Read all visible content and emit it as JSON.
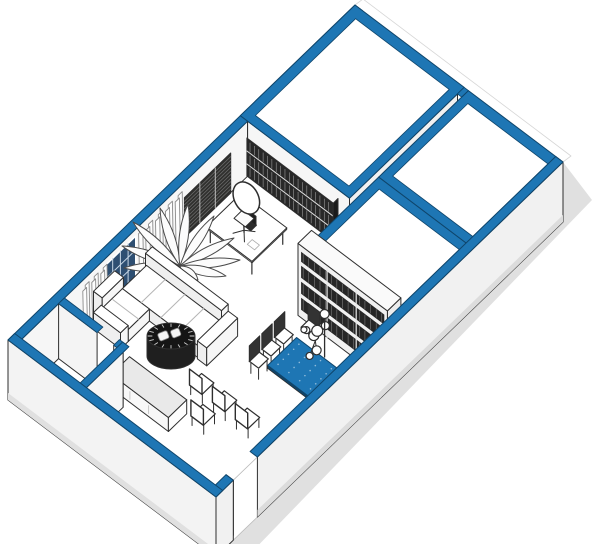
{
  "scene": {
    "label": "Isometric cutaway floor plan of an office suite with blue accent wall tops",
    "background": "#ffffff",
    "canvas": {
      "width": 600,
      "height": 544
    }
  },
  "palette": {
    "accent": "#1E76B4",
    "accent_dark": "#0F456B",
    "ink": "#2E2E2E",
    "glass": "#2E4F72",
    "glass_line": "#C7D6E4",
    "dark_furniture": "#262626",
    "slat_line": "#6E6E6E",
    "wall_face": "#F6F6F6",
    "wall_face_shaded": "#EFEFEF",
    "outer_wall": "#F1F1F1",
    "outer_wall_shade": "#DCDCDC",
    "floor": "#FFFFFF",
    "roof": "#FFFFFF",
    "shadow": "#CBCBCB",
    "counter_top": "#E9E9E9",
    "door": "#EBEBEB",
    "chair_back_dark": "#333333",
    "table_top": "#1E76B4",
    "table_edge": "#18679F",
    "cushion_line": "#B5B5B5",
    "curtain_line": "#8B8B8B",
    "leaf_line": "#4A4A4A"
  },
  "rooms": [
    {
      "name": "large-room-top",
      "roofed": true
    },
    {
      "name": "meeting-room-right",
      "roofed": true
    },
    {
      "name": "small-room-lower-right",
      "roofed": true
    },
    {
      "name": "open-office",
      "roofed": false
    },
    {
      "name": "storage-room-west",
      "roofed": false
    }
  ],
  "furniture": [
    {
      "item": "executive-desk"
    },
    {
      "item": "office-chair"
    },
    {
      "item": "desk-lamp"
    },
    {
      "item": "laptop"
    },
    {
      "item": "wall-bookshelf"
    },
    {
      "item": "window-blind-panel"
    },
    {
      "item": "window"
    },
    {
      "item": "curtains",
      "count": 2
    },
    {
      "item": "potted-plant"
    },
    {
      "item": "l-shaped-sofa"
    },
    {
      "item": "drum-coffee-table"
    },
    {
      "item": "divider-bookshelf"
    },
    {
      "item": "conference-table"
    },
    {
      "item": "conference-chairs",
      "count": 4
    },
    {
      "item": "sphere-decor"
    },
    {
      "item": "floor-lamp"
    },
    {
      "item": "waiting-chairs",
      "count": 4
    },
    {
      "item": "reception-counter"
    },
    {
      "item": "open-door"
    },
    {
      "item": "entrance-opening"
    }
  ]
}
